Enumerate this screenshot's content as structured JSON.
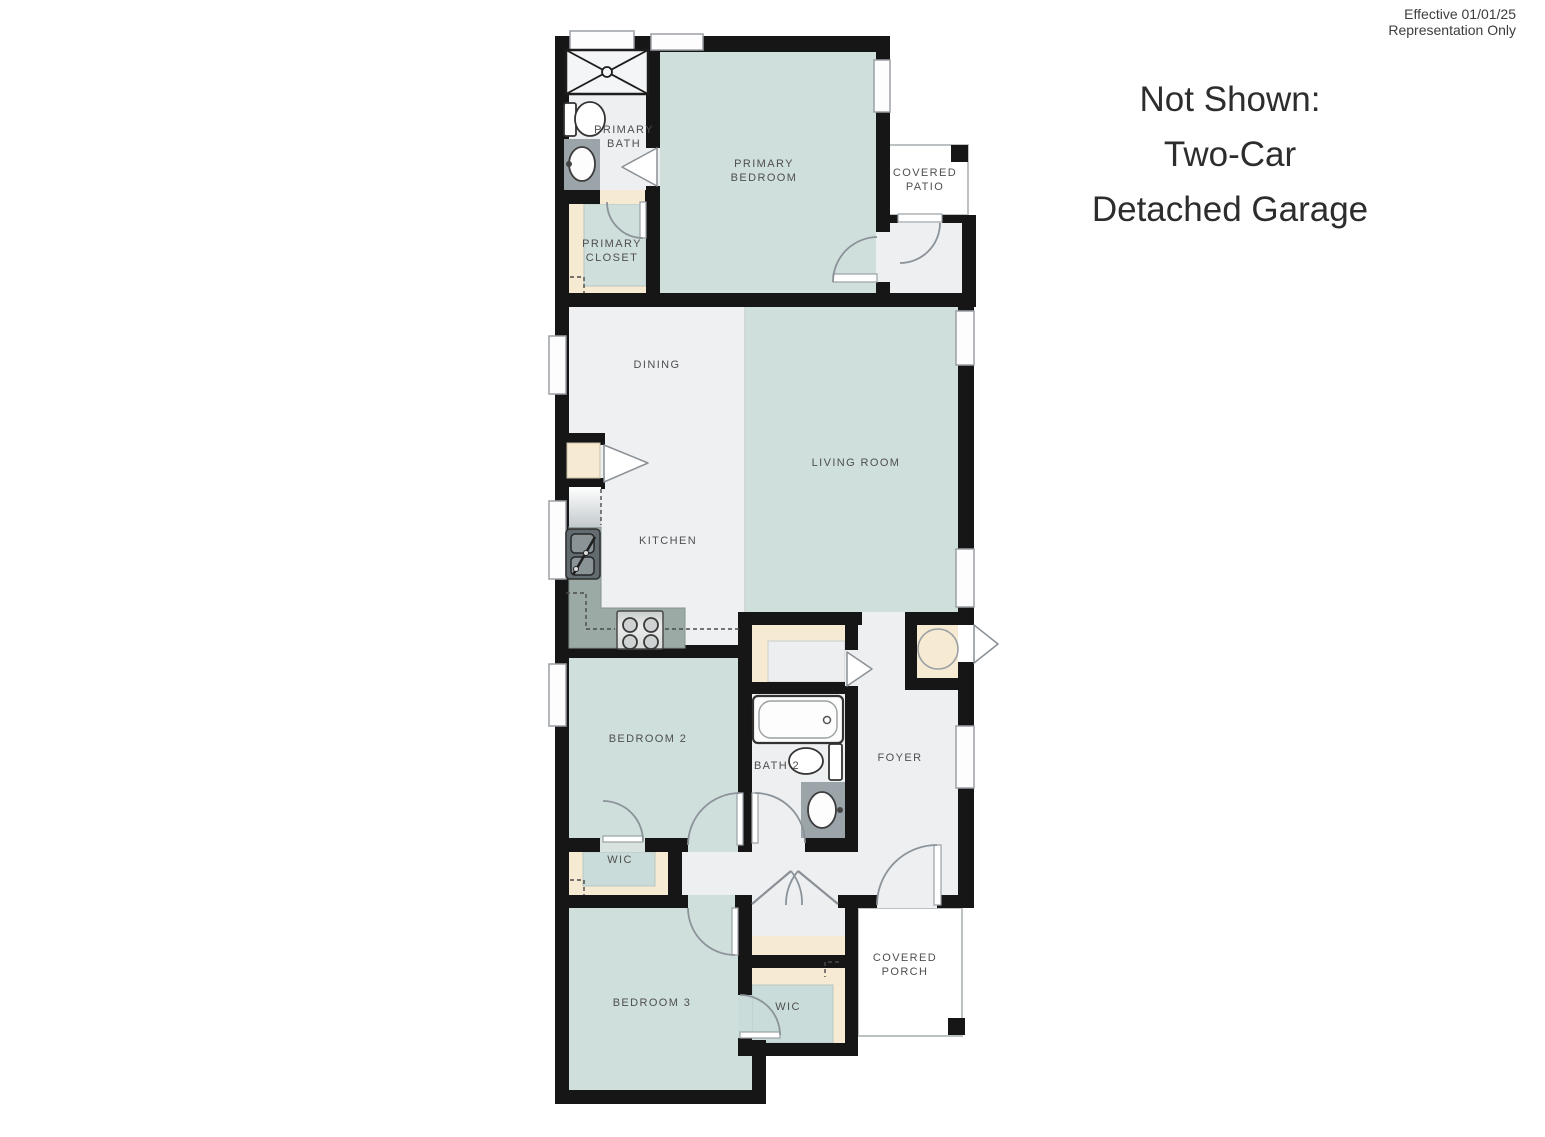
{
  "meta": {
    "effective": "Effective 01/01/25",
    "representation": "Representation Only"
  },
  "note": {
    "line1": "Not Shown:",
    "line2": "Two-Car",
    "line3": "Detached Garage"
  },
  "rooms": {
    "primary_bath_1": "PRIMARY",
    "primary_bath_2": "BATH",
    "primary_closet_1": "PRIMARY",
    "primary_closet_2": "CLOSET",
    "primary_bedroom_1": "PRIMARY",
    "primary_bedroom_2": "BEDROOM",
    "covered_patio_1": "COVERED",
    "covered_patio_2": "PATIO",
    "dining": "DINING",
    "living_room": "LIVING ROOM",
    "kitchen": "KITCHEN",
    "bedroom2": "BEDROOM 2",
    "bath2": "BATH 2",
    "foyer": "FOYER",
    "wic2": "WIC",
    "bedroom3": "BEDROOM 3",
    "wic3": "WIC",
    "covered_porch_1": "COVERED",
    "covered_porch_2": "PORCH"
  },
  "colors": {
    "wall": "#161616",
    "room_teal": "#cfdfdc",
    "room_gray": "#edeff1",
    "closet_tan": "#f6ead3",
    "counter": "#9baaa4",
    "vanity": "#9aa4a9",
    "outdoor_border": "#bcc1c4"
  }
}
